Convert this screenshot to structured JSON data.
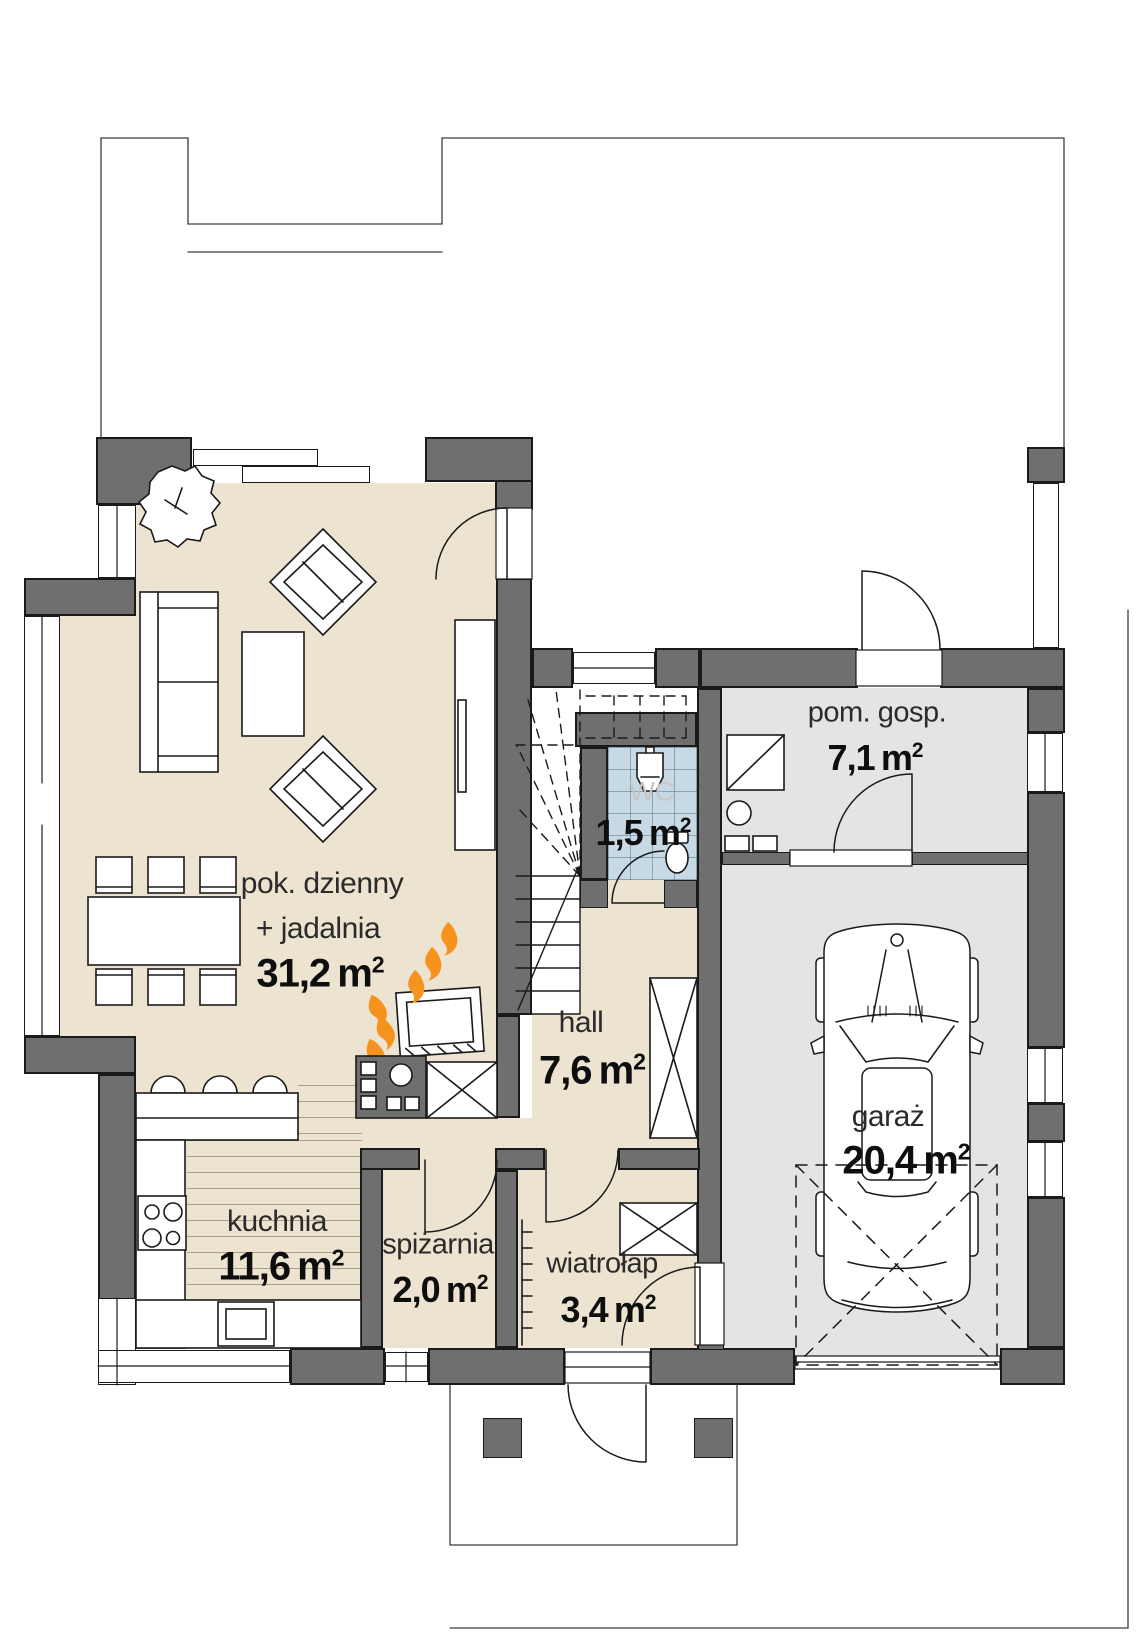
{
  "colors": {
    "wall": "#6f6f6f",
    "line": "#1a1a1a",
    "floor": "#ece4d0",
    "garage_floor": "#e4e4e4",
    "wc_floor": "#c6d9e4",
    "flame": "#f6921e",
    "label": "#1a1a1a",
    "wc_label": "#c6c6c6"
  },
  "rooms": {
    "living": {
      "name_line1": "pok. dzienny",
      "name_line2": "+ jadalnia",
      "area": "31,2",
      "unit": "m",
      "exp": "2"
    },
    "kitchen": {
      "name": "kuchnia",
      "area": "11,6",
      "unit": "m",
      "exp": "2"
    },
    "pantry": {
      "name": "spiżarnia",
      "area": "2,0",
      "unit": "m",
      "exp": "2"
    },
    "vestibule": {
      "name": "wiatrołap",
      "area": "3,4",
      "unit": "m",
      "exp": "2"
    },
    "hall": {
      "name": "hall",
      "area": "7,6",
      "unit": "m",
      "exp": "2"
    },
    "wc": {
      "name": "WC",
      "area": "1,5",
      "unit": "m",
      "exp": "2"
    },
    "utility": {
      "name": "pom. gosp.",
      "area": "7,1",
      "unit": "m",
      "exp": "2"
    },
    "garage": {
      "name": "garaż",
      "area": "20,4",
      "unit": "m",
      "exp": "2"
    }
  }
}
